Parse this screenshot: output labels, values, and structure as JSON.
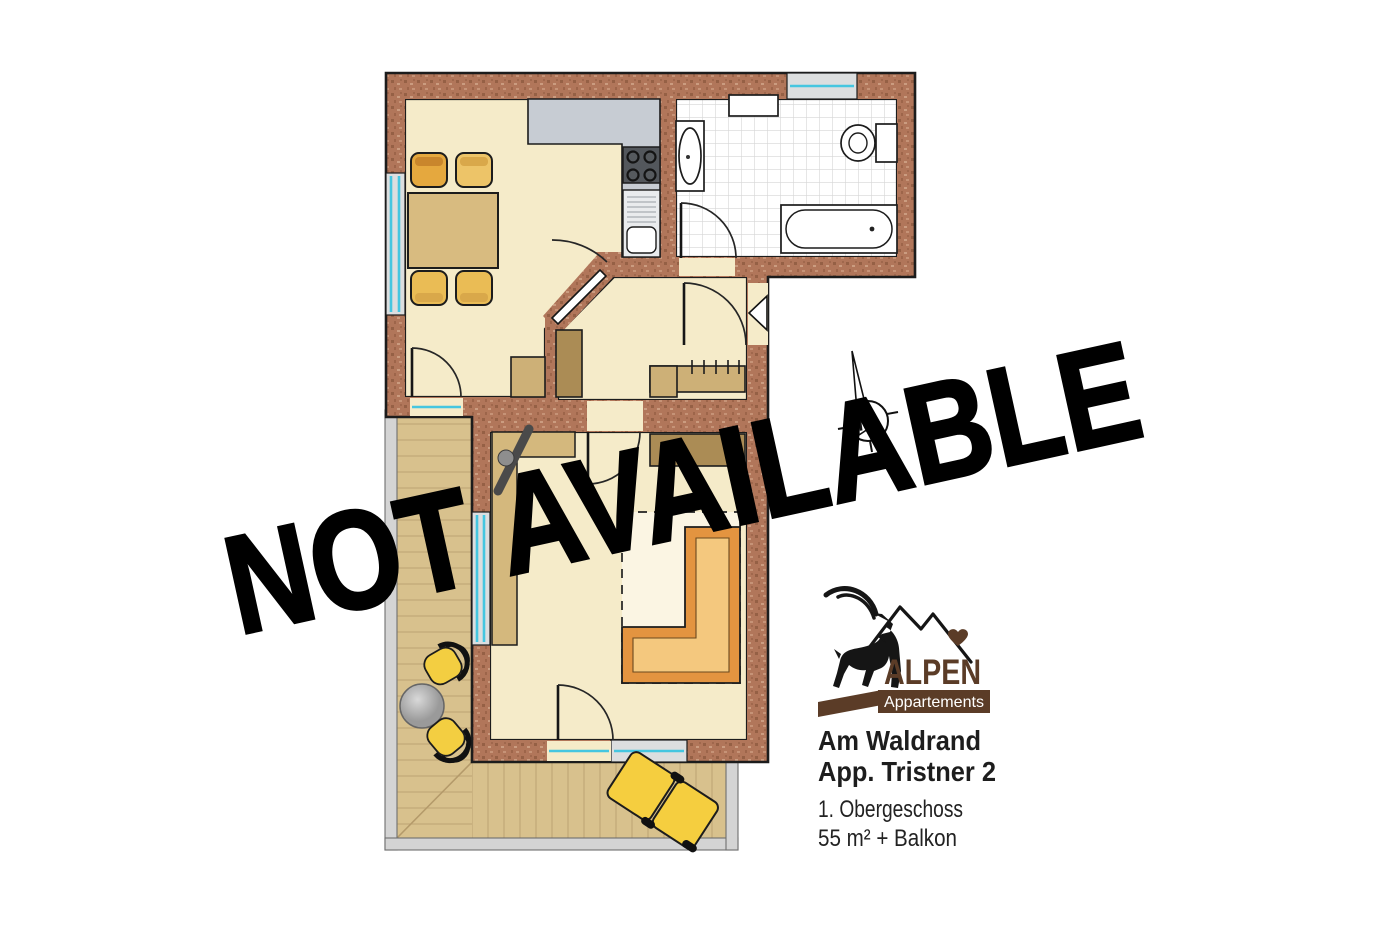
{
  "watermark": {
    "text": "NOT AVAILABLE"
  },
  "compass": {
    "north_label": "N"
  },
  "logo": {
    "brand": "ALPEN",
    "subtitle": "Appartements"
  },
  "listing": {
    "name_line1": "Am Waldrand",
    "name_line2": "App. Tristner 2",
    "floor": "1. Obergeschoss",
    "area": "55 m² + Balkon"
  },
  "colors": {
    "page_bg": "#ffffff",
    "outline": "#1c1c1c",
    "wall_base": "#b1765a",
    "wall_fleck_dark": "#8f5a40",
    "wall_fleck_light": "#cfa084",
    "floor": "#f5ebc9",
    "tile_line": "#d6d6d6",
    "counter": "#c7ccd3",
    "appliance": "#53575c",
    "table": "#d8bb80",
    "cabinet": "#cdb077",
    "closet": "#ab8c55",
    "shelf": "#d4b87d",
    "sofa_dark": "#e39440",
    "sofa_light": "#f4c87e",
    "wood": "#d8c18d",
    "wood_line": "#c2a777",
    "railing": "#d4d4d4",
    "glass": "#45c6e0",
    "frame": "#dcdedf",
    "chair_yellow": "#f3ce41",
    "lounger": "#f5ce3f",
    "brand": "#5b3c27",
    "text": "#1d1d1d",
    "watermark": "#000000"
  }
}
